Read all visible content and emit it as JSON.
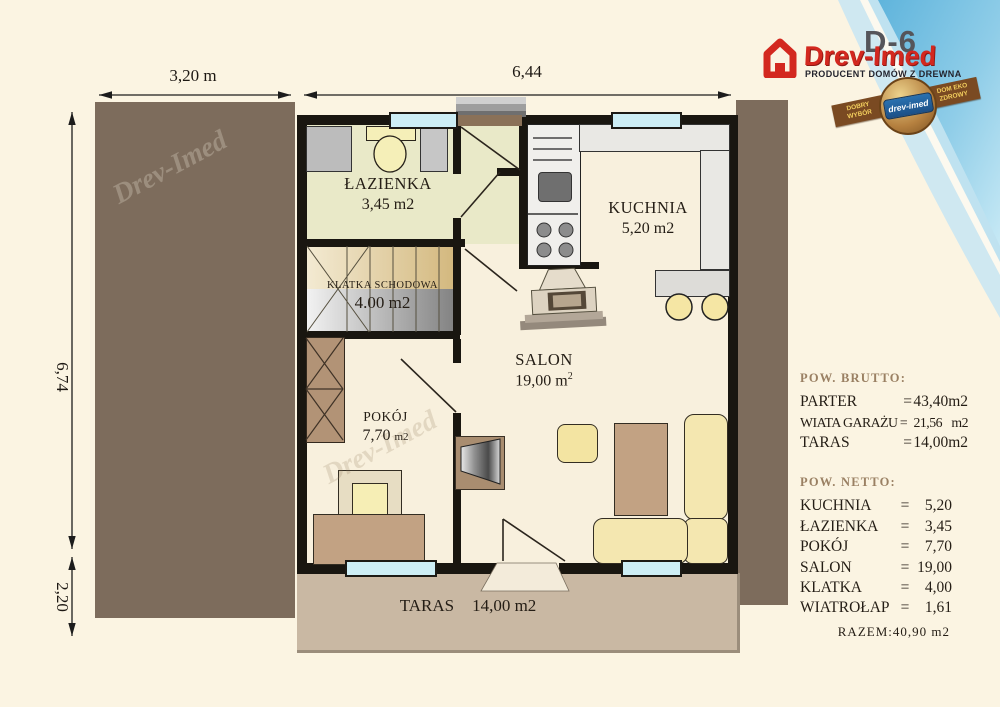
{
  "header": {
    "model_code": "D-6",
    "brand": "Drev-Imed",
    "tagline": "PRODUCENT DOMÓW Z DREWNA",
    "badge": {
      "left_top": "DOBRY",
      "left_bottom": "WYBÓR",
      "right_top": "DOM EKO",
      "right_bottom": "ZDROWY",
      "seal": "drev-imed"
    }
  },
  "dimensions": {
    "top_left": "3,20 m",
    "top_main": "6,44",
    "side_upper": "6,74",
    "side_lower": "2,20"
  },
  "rooms": {
    "lazienka": {
      "name": "ŁAZIENKA",
      "area": "3,45 m2"
    },
    "kuchnia": {
      "name": "KUCHNIA",
      "area": "5,20 m2"
    },
    "klatka": {
      "name": "KLATKA SCHODOWA",
      "area": "4.00 m2"
    },
    "pokoj": {
      "name": "POKÓJ",
      "area_value": "7,70",
      "area_unit": "m2"
    },
    "salon": {
      "name": "SALON",
      "area_value": "19,00",
      "area_unit": "m",
      "area_sup": "2"
    },
    "taras": {
      "name": "TARAS",
      "area": "14,00 m2"
    }
  },
  "watermark": "Drev-Imed",
  "summary": {
    "brutto": {
      "title": "POW. BRUTTO:",
      "rows": [
        {
          "label": "PARTER",
          "eq": "=",
          "value": "43,40",
          "unit": "m2"
        },
        {
          "label": "WIATA GARAŻU",
          "eq": "=",
          "value": "21,56",
          "unit": "m2"
        },
        {
          "label": "TARAS",
          "eq": "=",
          "value": "14,00",
          "unit": "m2"
        }
      ]
    },
    "netto": {
      "title": "POW. NETTO:",
      "rows": [
        {
          "label": "KUCHNIA",
          "eq": "=",
          "value": "5,20"
        },
        {
          "label": "ŁAZIENKA",
          "eq": "=",
          "value": "3,45"
        },
        {
          "label": "POKÓJ",
          "eq": "=",
          "value": "7,70"
        },
        {
          "label": "SALON",
          "eq": "=",
          "value": "19,00"
        },
        {
          "label": "KLATKA",
          "eq": "=",
          "value": "4,00"
        },
        {
          "label": "WIATROŁAP",
          "eq": "=",
          "value": "1,61"
        }
      ],
      "total": "RAZEM:40,90  m2"
    }
  },
  "colors": {
    "accent_red": "#d3281f",
    "wall_black": "#191610",
    "carport_brown": "#7d6c5c",
    "terrace_tan": "#c9b8a3",
    "window_cyan": "#cdeef5",
    "floor_cream": "#f8f0dd",
    "bath_olive": "#e9e9c8",
    "decor_blue": "#62b7de"
  }
}
